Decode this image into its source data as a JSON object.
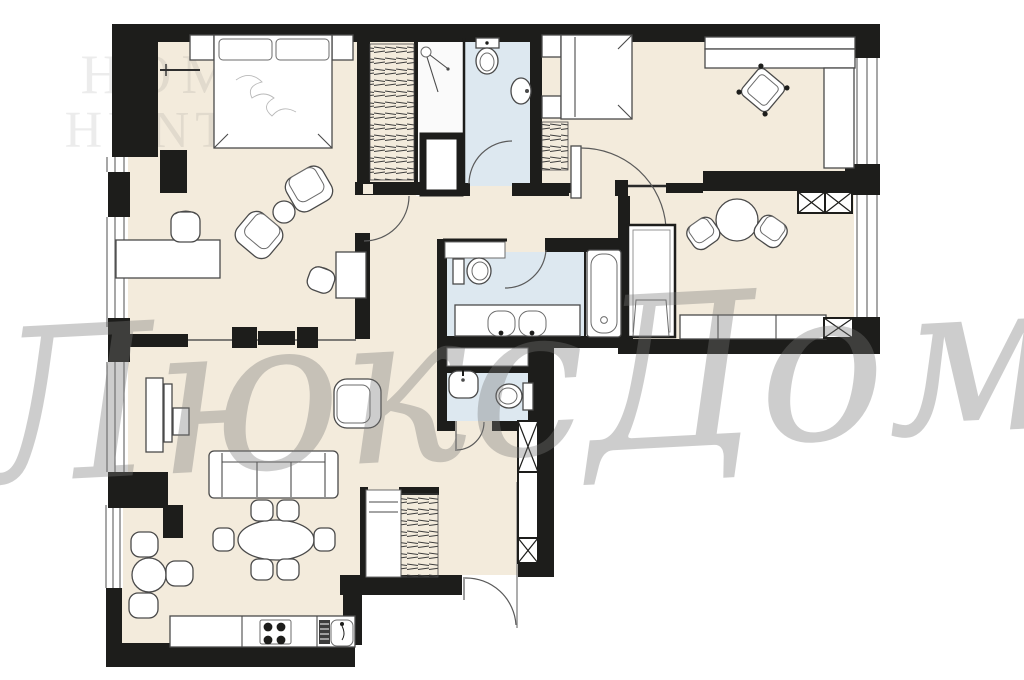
{
  "watermarks": {
    "brand_line1": "HOME",
    "brand_line2": "HUNTER",
    "agency_script": "ЛюксДом"
  },
  "palette": {
    "wall": "#1d1d1b",
    "floor_beige": "#f3ebdc",
    "wet_floor_blue": "#dde8f0",
    "furniture_outline": "#4a4a4a",
    "furniture_fill": "#ffffff",
    "brand_watermark_gray": "#e6e6e6",
    "script_watermark_gray": "#8a8a8a",
    "background": "#ffffff"
  },
  "plan": {
    "type": "apartment-floor-plan",
    "rooms": [
      "bedroom-1",
      "walk-in-wardrobe",
      "shower-bathroom",
      "bedroom-2",
      "sitting-room",
      "main-bathroom",
      "guest-wc",
      "hallway",
      "living-room-kitchen",
      "bay-dining-nook"
    ]
  }
}
